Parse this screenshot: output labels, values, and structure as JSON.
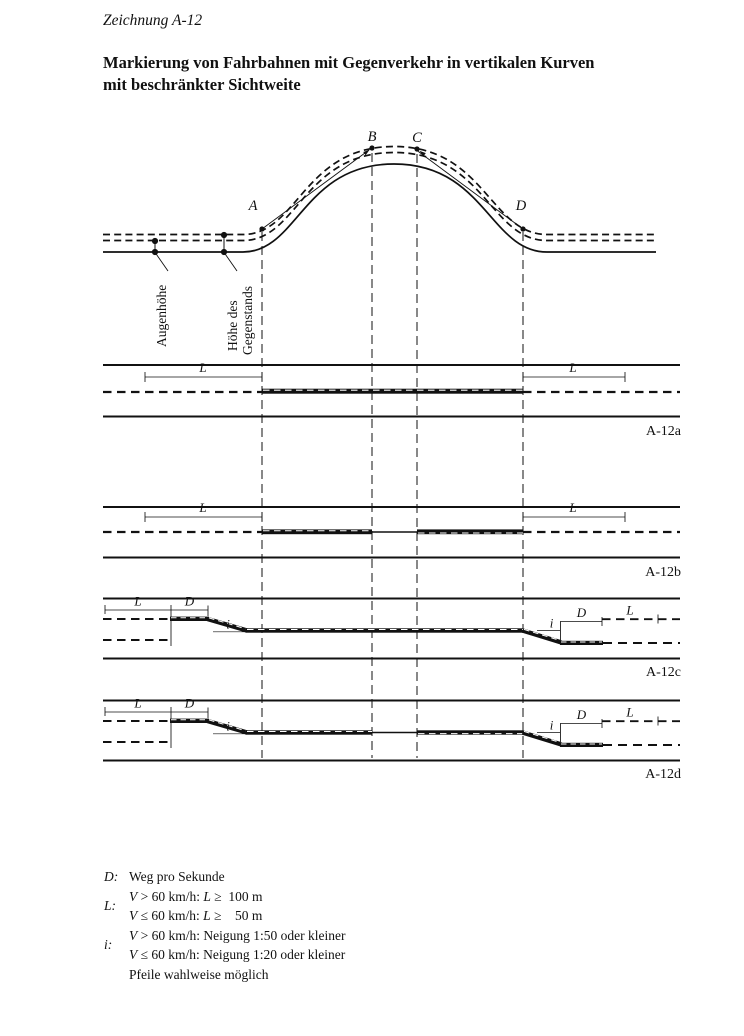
{
  "header": {
    "drawing_label": "Zeichnung A-12",
    "title_line1": "Markierung von Fahrbahnen mit Gegenverkehr in vertikalen Kurven",
    "title_line2": "mit beschränkter Sichtweite"
  },
  "diagram": {
    "point_a": "A",
    "point_b": "B",
    "point_c": "C",
    "point_d": "D",
    "eye_height_label": "Augenhöhe",
    "object_height_label_line1": "Höhe des",
    "object_height_label_line2": "Gegenstands"
  },
  "bands": {
    "a": {
      "label": "A-12a",
      "l_left": "L",
      "l_right": "L"
    },
    "b": {
      "label": "A-12b",
      "l_left": "L",
      "l_right": "L"
    },
    "c": {
      "label": "A-12c",
      "l_left": "L",
      "d_left": "D",
      "i_left": "i",
      "i_right": "i",
      "d_right": "D",
      "l_right": "L"
    },
    "d": {
      "label": "A-12d",
      "l_left": "L",
      "d_left": "D",
      "i_left": "i",
      "i_right": "i",
      "d_right": "D",
      "l_right": "L"
    }
  },
  "legend": {
    "d_key": "D:",
    "d_text": "Weg pro Sekunde",
    "l_key": "L:",
    "l_line1": {
      "v": "V",
      "mid": " > 60 km/h: ",
      "sym": "L",
      "tail": " ≥  100 m"
    },
    "l_line2": {
      "v": "V",
      "mid": " ≤ 60 km/h: ",
      "sym": "L",
      "tail": " ≥    50 m"
    },
    "i_key": "i:",
    "i_line1": {
      "v": "V",
      "mid": " > 60 km/h: Neigung 1:50 oder kleiner",
      "sym": "",
      "tail": ""
    },
    "i_line2": {
      "v": "V",
      "mid": " ≤ 60 km/h: Neigung 1:20 oder kleiner",
      "sym": "",
      "tail": ""
    },
    "arrows_note": "Pfeile wahlweise möglich"
  }
}
